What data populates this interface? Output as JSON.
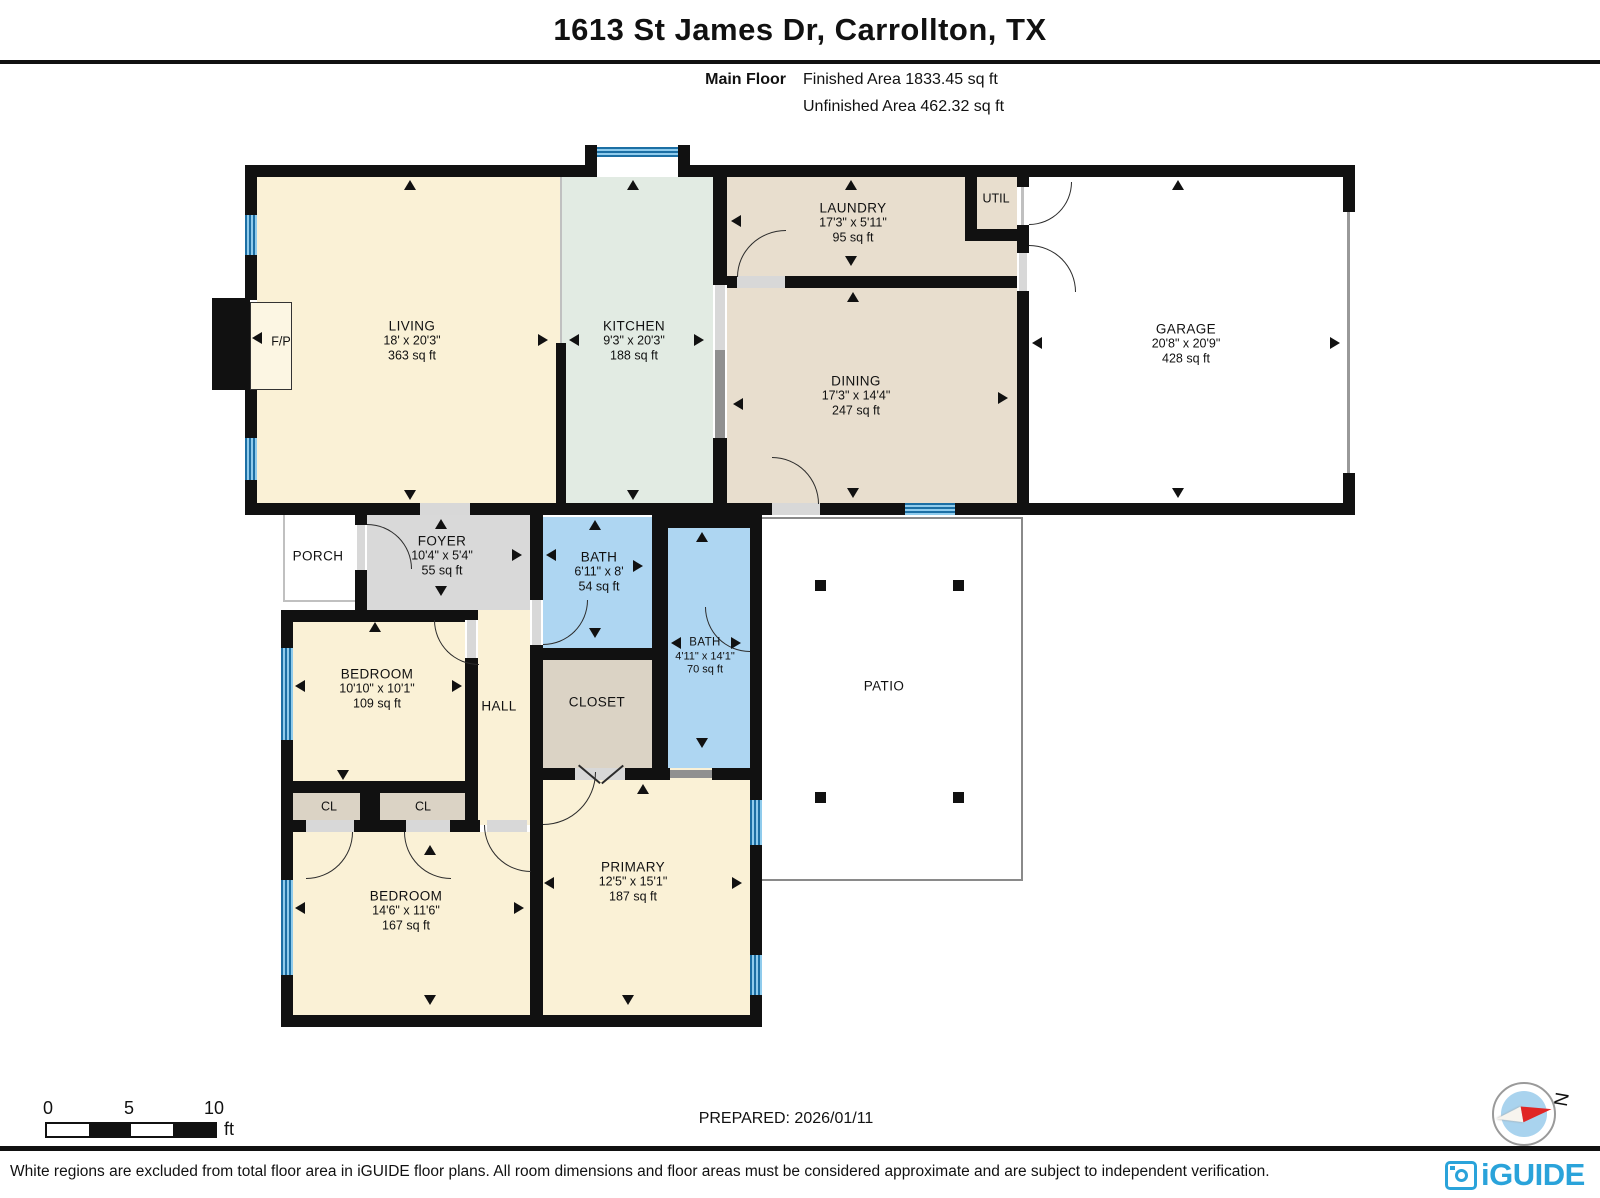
{
  "header": {
    "title": "1613 St James Dr, Carrollton, TX",
    "floor_label": "Main Floor",
    "finished_area": "Finished Area 1833.45 sq ft",
    "unfinished_area": "Unfinished Area 462.32 sq ft"
  },
  "rooms": {
    "living": {
      "name": "LIVING",
      "dims": "18' x 20'3\"",
      "area": "363 sq ft"
    },
    "kitchen": {
      "name": "KITCHEN",
      "dims": "9'3\" x 20'3\"",
      "area": "188 sq ft"
    },
    "laundry": {
      "name": "LAUNDRY",
      "dims": "17'3\" x 5'11\"",
      "area": "95 sq ft"
    },
    "util": {
      "name": "UTIL"
    },
    "garage": {
      "name": "GARAGE",
      "dims": "20'8\" x 20'9\"",
      "area": "428 sq ft"
    },
    "dining": {
      "name": "DINING",
      "dims": "17'3\" x 14'4\"",
      "area": "247 sq ft"
    },
    "porch": {
      "name": "PORCH"
    },
    "foyer": {
      "name": "FOYER",
      "dims": "10'4\" x 5'4\"",
      "area": "55 sq ft"
    },
    "bath_main": {
      "name": "BATH",
      "dims": "6'11\" x 8'",
      "area": "54 sq ft"
    },
    "bath_second": {
      "name": "BATH",
      "dims": "4'11\" x 14'1\"",
      "area": "70 sq ft"
    },
    "bedroom_small": {
      "name": "BEDROOM",
      "dims": "10'10\" x 10'1\"",
      "area": "109 sq ft"
    },
    "hall": {
      "name": "HALL"
    },
    "closet": {
      "name": "CLOSET"
    },
    "cl_left": {
      "name": "CL"
    },
    "cl_right": {
      "name": "CL"
    },
    "bedroom_large": {
      "name": "BEDROOM",
      "dims": "14'6\" x 11'6\"",
      "area": "167 sq ft"
    },
    "primary": {
      "name": "PRIMARY",
      "dims": "12'5\" x 15'1\"",
      "area": "187 sq ft"
    },
    "patio": {
      "name": "PATIO"
    },
    "fireplace": {
      "name": "F/P"
    }
  },
  "scale_bar": {
    "tick_0": "0",
    "tick_5": "5",
    "tick_10": "10",
    "unit": "ft"
  },
  "prepared_label": "PREPARED: 2026/01/11",
  "compass": {
    "north_label": "N"
  },
  "footer": {
    "disclaimer": "White regions are excluded from total floor area in iGUIDE floor plans. All room dimensions and floor areas must be considered approximate and are subject to independent verification.",
    "brand": "iGUIDE"
  },
  "colors": {
    "wall": "#111111",
    "living_cream": "#FAF1D6",
    "kitchen_green": "#E2EBE3",
    "dining_tan": "#E8DECE",
    "bath_blue": "#AED6F2",
    "foyer_gray": "#D9D9D9",
    "closet_warm": "#DBD3C5",
    "window_blue": "#4BA6D9",
    "brand_blue": "#2AA3DA",
    "compass_red": "#E02525"
  }
}
